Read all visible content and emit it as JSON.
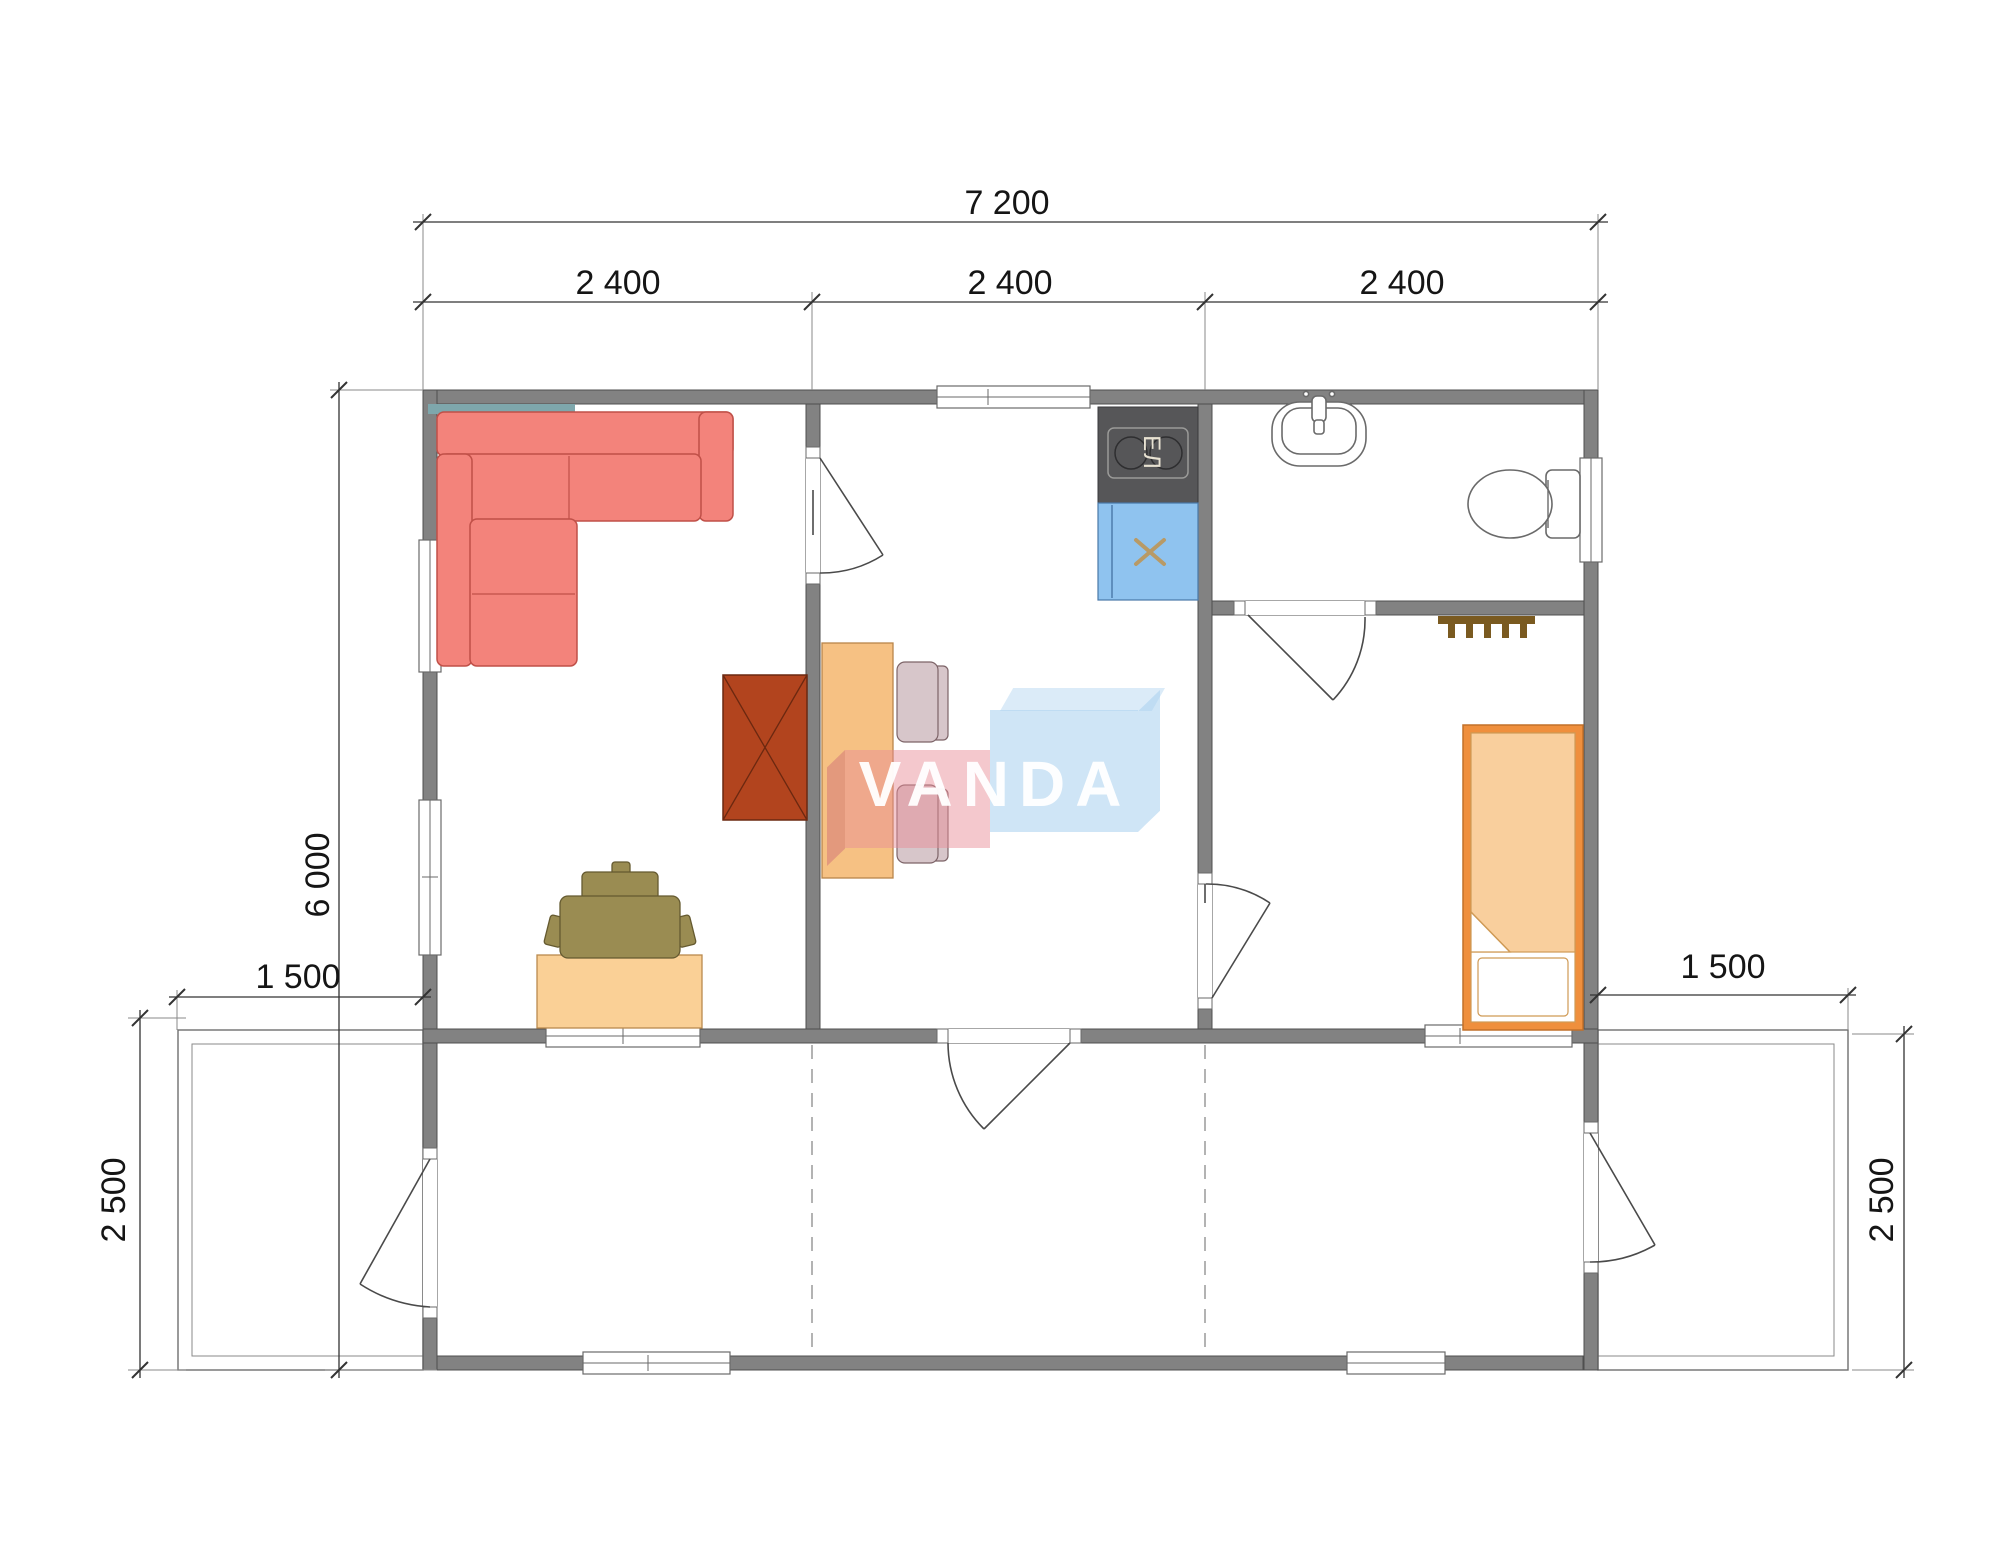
{
  "title": "floor-plan",
  "watermark": {
    "text": "VANDA"
  },
  "dims": {
    "total_width": "7 200",
    "module_1": "2 400",
    "module_2": "2 400",
    "module_3": "2 400",
    "total_depth": "6 000",
    "terrace_left_width": "1 500",
    "terrace_right_width": "1 500",
    "terrace_left_depth": "2 500",
    "terrace_right_depth": "2 500"
  },
  "labels": {
    "stove": "ЕЛ"
  },
  "colors": {
    "wall": "#828282",
    "wall_edge": "#4f4f4f",
    "fixture": "#6a6a6a",
    "dim": "#333333",
    "sofa": "#F3837B",
    "sofa_edge": "#C05048",
    "sofa_back": "#7EA7AC",
    "wardrobe": "#B2441E",
    "desk": "#FAD096",
    "chair_olive": "#9A8C52",
    "table": "#F6C183",
    "chair_mauve": "#D7C6CA",
    "stove": "#565658",
    "sink_blue": "#8FC3EF",
    "bed_frame": "#EF8F3D",
    "mattress": "#F9CF9D",
    "towel": "#7A5A20",
    "wm_pink": "rgba(233,140,150,0.48)",
    "wm_pink_dark": "rgba(205,105,118,0.45)",
    "wm_blue": "rgba(168,207,238,0.55)",
    "wm_blue_light": "rgba(195,222,244,0.6)",
    "wm_text": "rgba(255,255,255,0.95)"
  }
}
